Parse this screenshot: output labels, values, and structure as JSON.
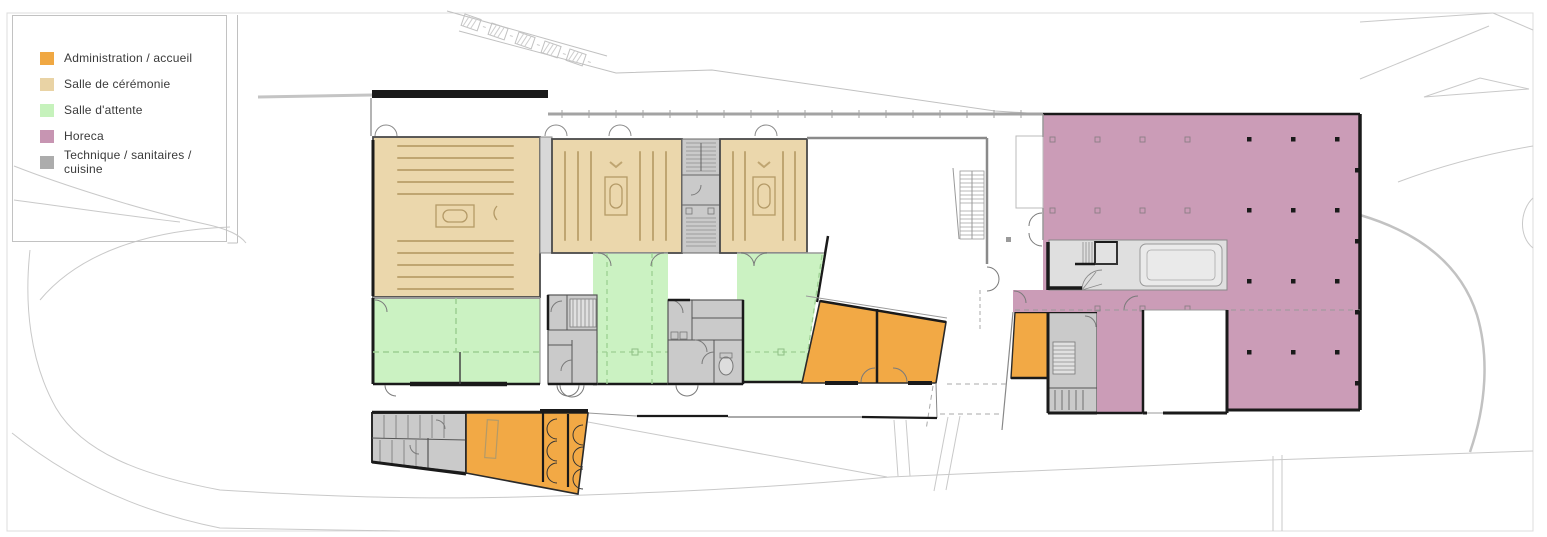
{
  "legend": {
    "items": [
      {
        "label": "Administration / accueil",
        "color": "#F0A843"
      },
      {
        "label": "Salle de cérémonie",
        "color": "#E9D3A5"
      },
      {
        "label": "Salle d'attente",
        "color": "#C6F2BC"
      },
      {
        "label": "Horeca",
        "color": "#C795B2"
      },
      {
        "label": "Technique / sanitaires / cuisine",
        "color": "#ACACAC"
      }
    ]
  },
  "plan": {
    "kind": "architectural floor plan",
    "zones": [
      "ceremony-hall-large",
      "ceremony-hall-medium",
      "ceremony-hall-small",
      "waiting-areas",
      "administration-offices",
      "reception-wing",
      "sanitary-cores",
      "horeca-hall",
      "kitchen-block",
      "courtyard",
      "parking-row"
    ]
  },
  "colors": {
    "admin": "#F2A945",
    "ceremony": "#EBD7AC",
    "waiting": "#CBF2C2",
    "horeca": "#CB9CB7",
    "technical": "#CACACA",
    "technical_light": "#DFDFDF",
    "wall": "#1A1A1A",
    "bench": "#BFA571",
    "site": "#C9C9C9",
    "dashed_green": "#9CCF92",
    "door": "#7A7A7A",
    "gray_wall": "#8A8A8A"
  }
}
